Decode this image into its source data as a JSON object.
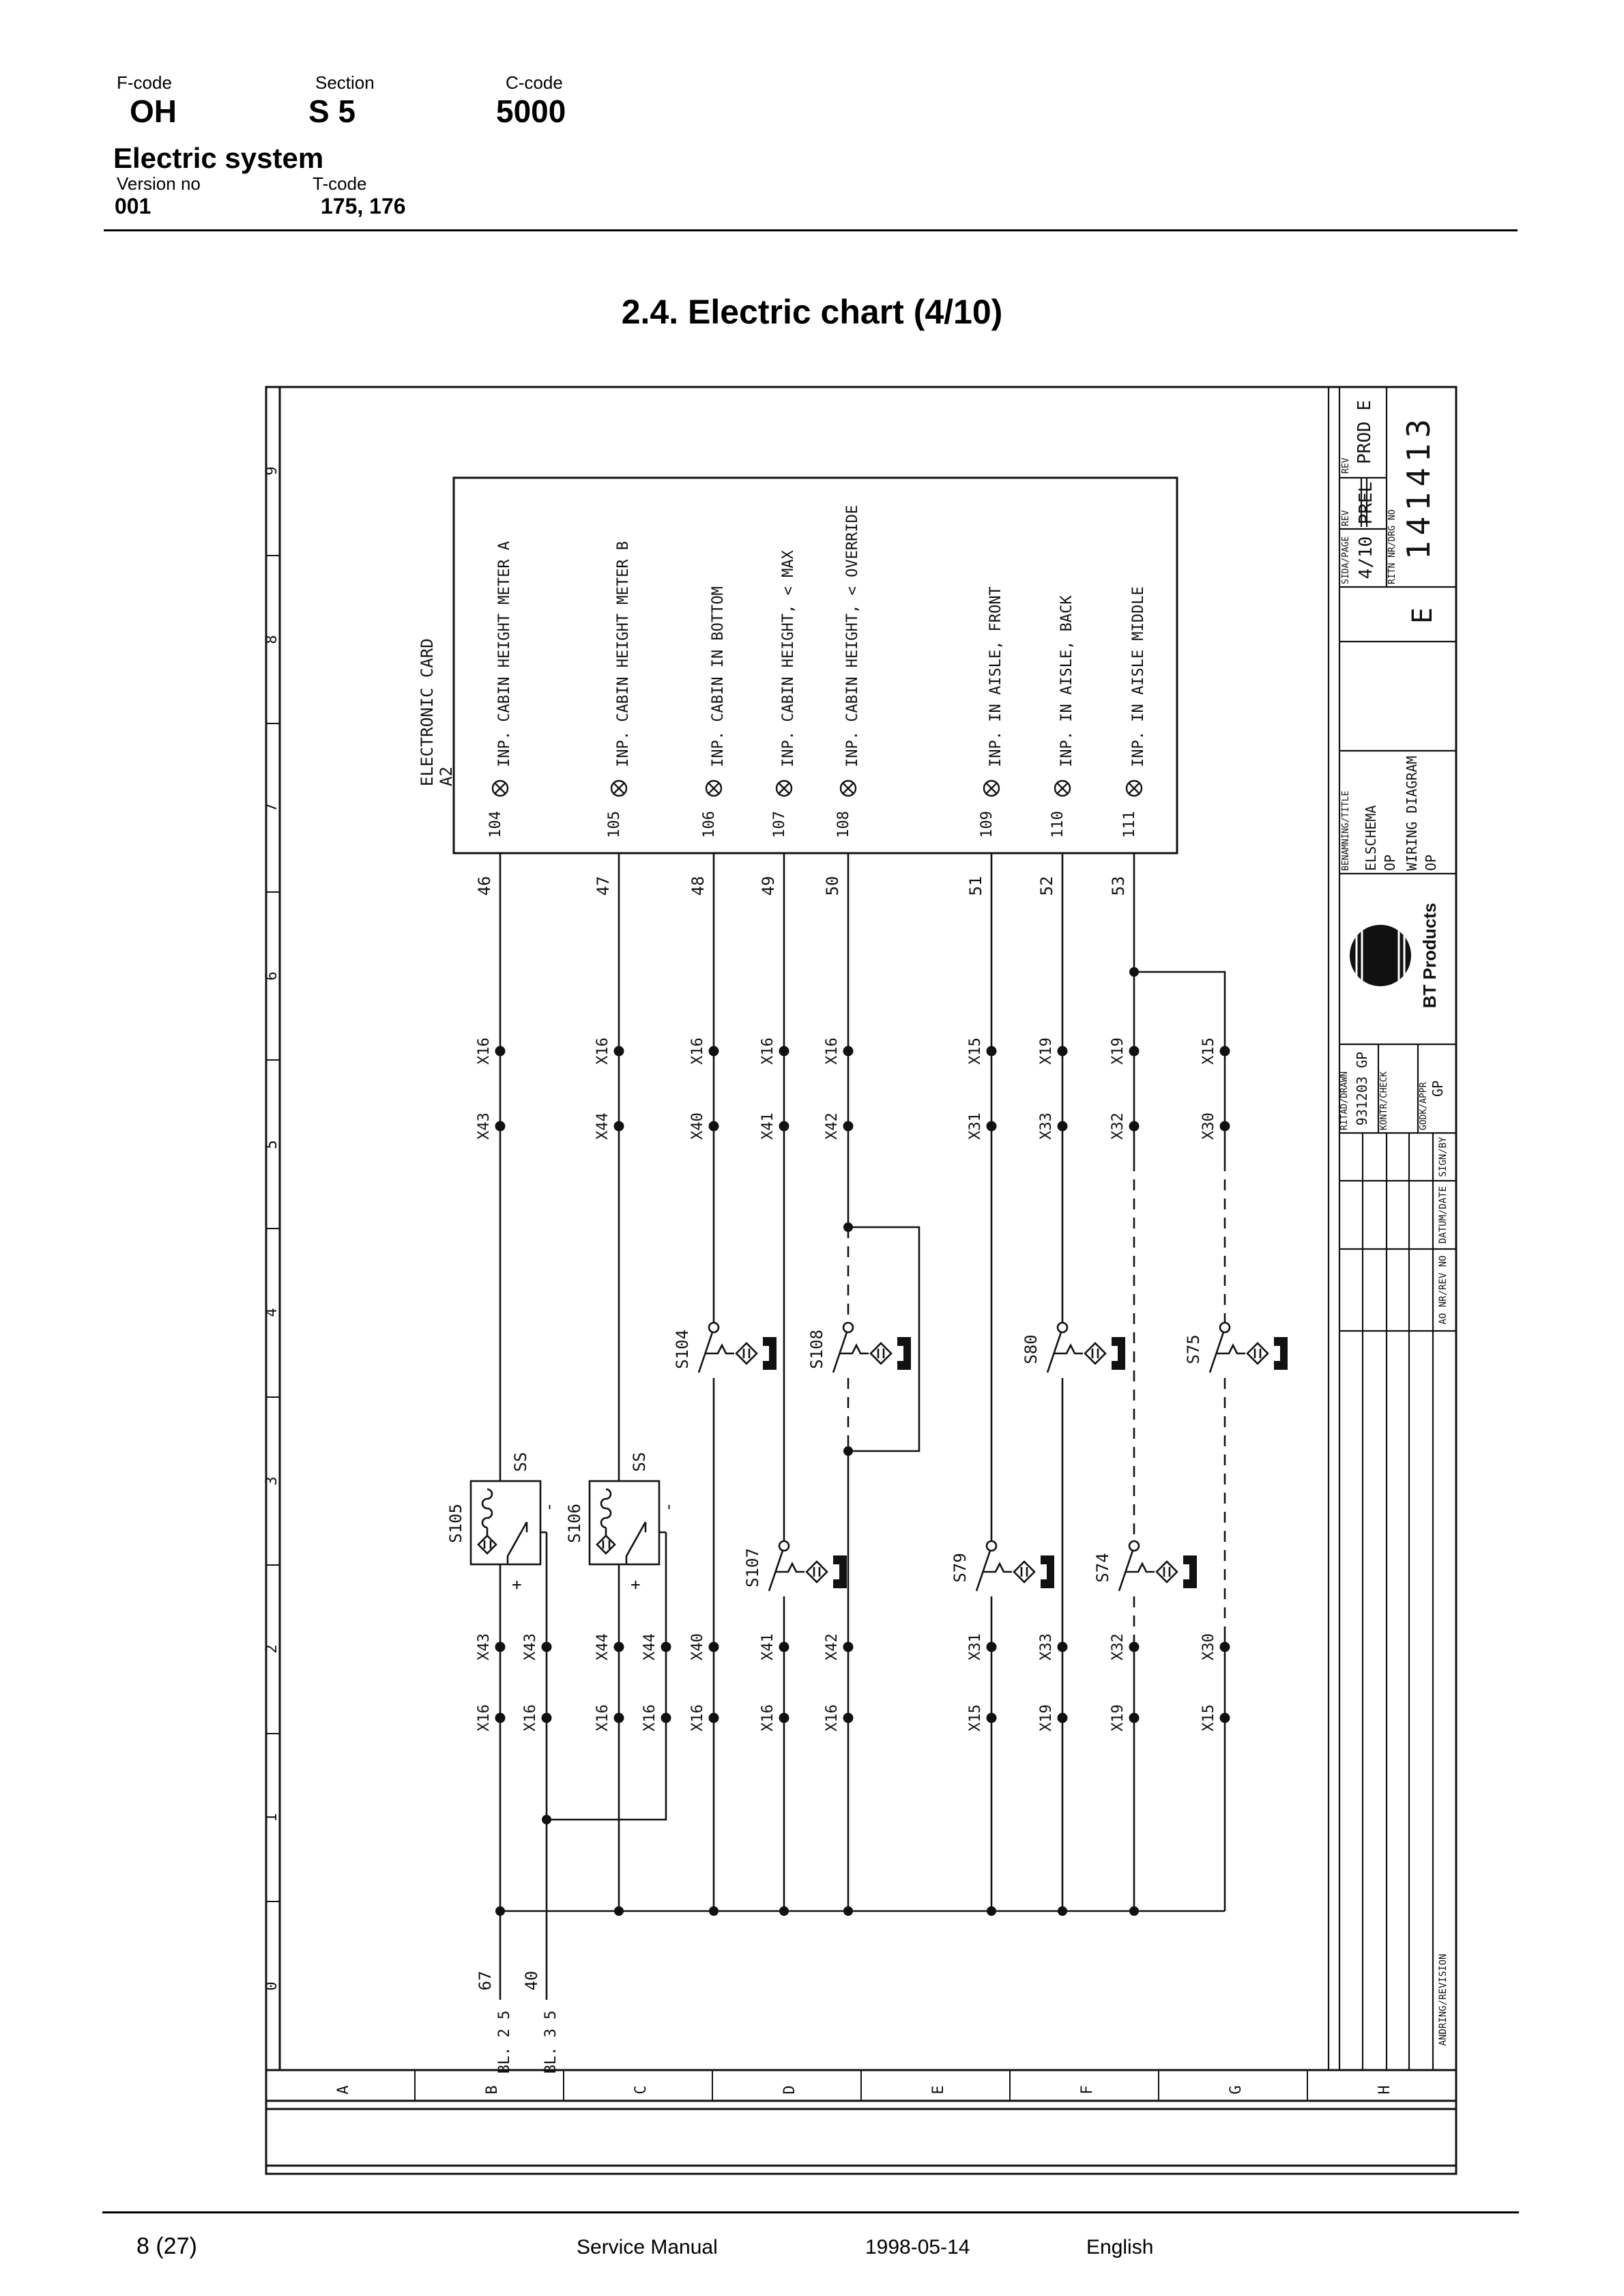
{
  "header": {
    "fcode_label": "F-code",
    "fcode": "OH",
    "section_label": "Section",
    "section": "S 5",
    "ccode_label": "C-code",
    "ccode": "5000",
    "system": "Electric system",
    "version_label": "Version no",
    "version": "001",
    "tcode_label": "T-code",
    "tcode": "175, 176"
  },
  "title": "2.4. Electric chart (4/10)",
  "footer": {
    "page": "8 (27)",
    "doc": "Service Manual",
    "date": "1998-05-14",
    "lang": "English"
  },
  "drawing": {
    "card": {
      "label": "ELECTRONIC CARD",
      "ref": "A2",
      "pins": [
        {
          "no": "104",
          "signal": "INP. CABIN HEIGHT METER A",
          "wire": "46"
        },
        {
          "no": "105",
          "signal": "INP. CABIN HEIGHT METER B",
          "wire": "47"
        },
        {
          "no": "106",
          "signal": "INP. CABIN IN BOTTOM",
          "wire": "48"
        },
        {
          "no": "107",
          "signal": "INP. CABIN HEIGHT, < MAX",
          "wire": "49"
        },
        {
          "no": "108",
          "signal": "INP. CABIN HEIGHT, < OVERRIDE",
          "wire": "50"
        },
        {
          "no": "109",
          "signal": "INP. IN AISLE, FRONT",
          "wire": "51"
        },
        {
          "no": "110",
          "signal": "INP. IN AISLE, BACK",
          "wire": "52"
        },
        {
          "no": "111",
          "signal": "INP. IN AISLE MIDDLE",
          "wire": "53"
        }
      ]
    },
    "upper_connectors": [
      {
        "a": "X16",
        "b": "X43"
      },
      {
        "a": "X16",
        "b": "X44"
      },
      {
        "a": "X16",
        "b": "X40"
      },
      {
        "a": "X16",
        "b": "X41"
      },
      {
        "a": "X16",
        "b": "X42"
      },
      {
        "a": "X15",
        "b": "X31"
      },
      {
        "a": "X19",
        "b": "X33"
      },
      {
        "a": "X19",
        "b": "X32"
      },
      {
        "a": "X15",
        "b": "X30"
      }
    ],
    "lower_connectors": [
      {
        "a": "X43",
        "b": "X16"
      },
      {
        "a": "X43",
        "b": "X16"
      },
      {
        "a": "X44",
        "b": "X16"
      },
      {
        "a": "X44",
        "b": "X16"
      },
      {
        "a": "X40",
        "b": "X16"
      },
      {
        "a": "X41",
        "b": "X16"
      },
      {
        "a": "X42",
        "b": "X16"
      },
      {
        "a": "X31",
        "b": "X15"
      },
      {
        "a": "X33",
        "b": "X19"
      },
      {
        "a": "X32",
        "b": "X19"
      },
      {
        "a": "X30",
        "b": "X15"
      }
    ],
    "switches": {
      "s104": "S104",
      "s108": "S108",
      "s80": "S80",
      "s75": "S75",
      "s107": "S107",
      "s79": "S79",
      "s74": "S74"
    },
    "sensors": {
      "s105": "S105",
      "s106": "S106",
      "ss": "SS",
      "plus": "+",
      "minus": "-"
    },
    "exits": [
      {
        "wire": "67",
        "ref": "BL. 2 5"
      },
      {
        "wire": "40",
        "ref": "BL. 3 5"
      }
    ],
    "col_scale": [
      "9",
      "8",
      "7",
      "6",
      "5",
      "4",
      "3",
      "2",
      "1",
      "0"
    ],
    "row_scale": [
      "A",
      "B",
      "C",
      "D",
      "E",
      "F",
      "G",
      "H"
    ],
    "titleblock": {
      "rev_label": "REV",
      "rev": "PROD E",
      "page_label": "SIDA/PAGE",
      "page": "4/10",
      "rev2_label": "REV",
      "rev2": "PREL",
      "drgno_label": "RITN NR/DRG NO",
      "drgno": "141413",
      "size": "E",
      "name_label": "BENAMNING/TITLE",
      "name1": "ELSCHEMA",
      "name2": "OP",
      "name3": "WIRING DIAGRAM",
      "name4": "OP",
      "logo": "BT",
      "brand": "BT Products",
      "drawn_label": "RITAD/DRAWN",
      "drawn": "931203  GP",
      "check_label": "KONTR/CHECK",
      "appr_label": "GODK/APPR",
      "appr": "GP",
      "sign_label": "SIGN/BY",
      "date_label": "DATUM/DATE",
      "rev_no_label": "AO NR/REV NO",
      "revision_label": "ANDRING/REVISION"
    }
  }
}
